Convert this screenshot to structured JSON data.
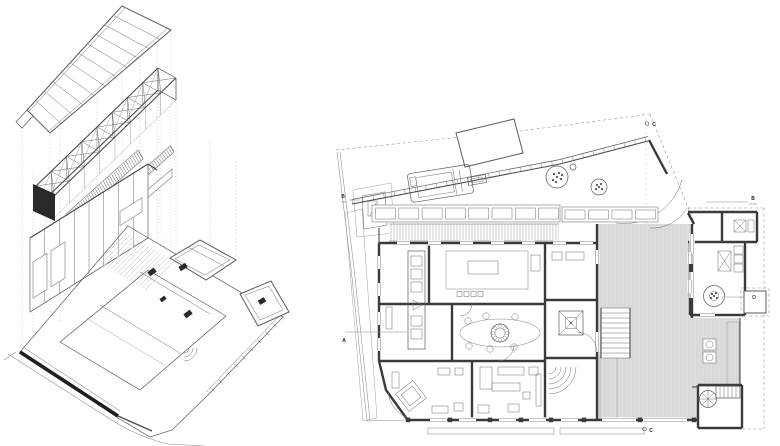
{
  "sheet": {
    "background": "#ffffff",
    "drawings": {
      "left": {
        "kind": "exploded-axonometric"
      },
      "right": {
        "kind": "ground-floor-plan"
      }
    }
  },
  "section_markers": [
    {
      "id": "b-left",
      "label": "B"
    },
    {
      "id": "a-left",
      "label": "A"
    },
    {
      "id": "c-top",
      "label": "C"
    },
    {
      "id": "b-right",
      "label": "B"
    },
    {
      "id": "a-right",
      "label": "A"
    },
    {
      "id": "c-bottom",
      "label": "C"
    }
  ],
  "colors": {
    "line": "#4a4a4a",
    "dark_wall": "#1f1f1f",
    "courtyard_fill": "#dcdcdc",
    "hatch": "#8a8a8a"
  }
}
